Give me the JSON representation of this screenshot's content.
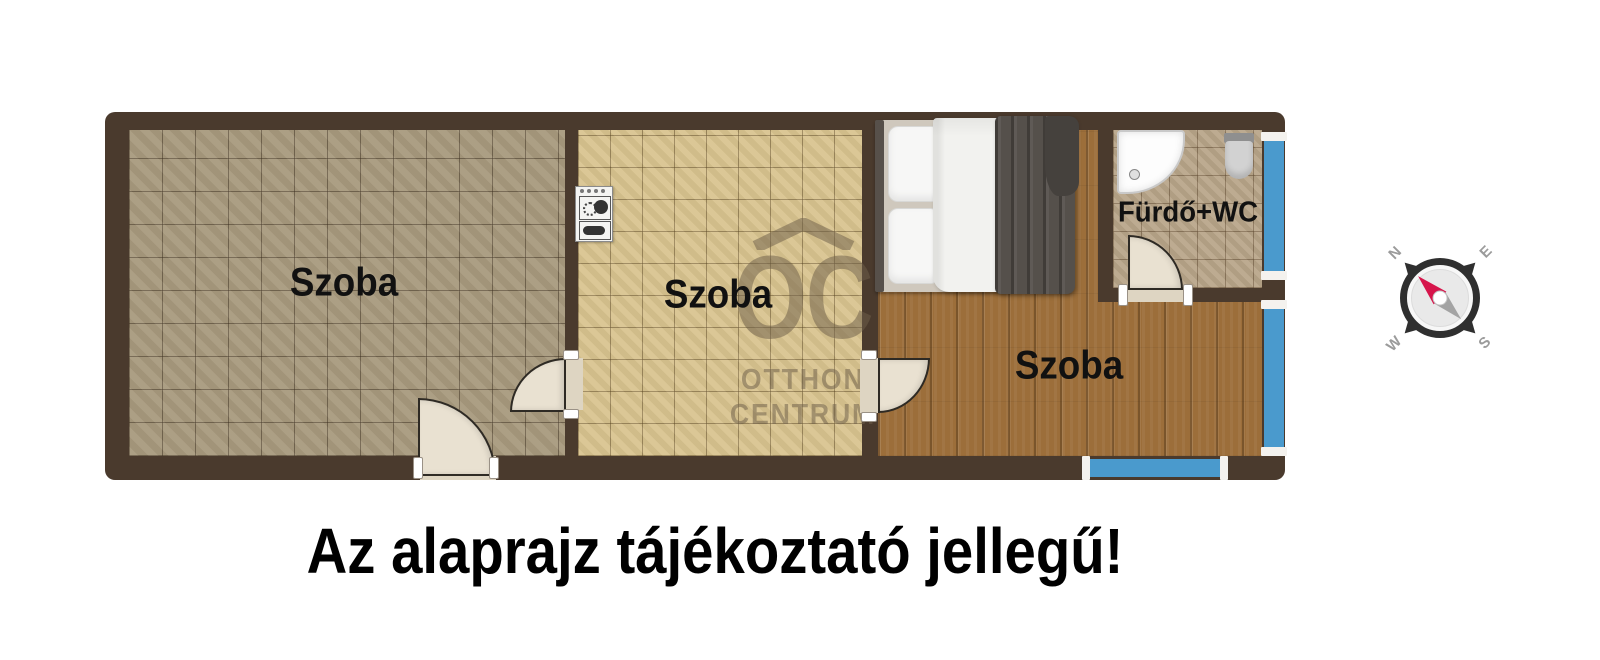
{
  "floorplan": {
    "disclaimer": "Az alaprajz tájékoztató jellegű!",
    "rooms": [
      {
        "id": "room-left",
        "label": "Szoba"
      },
      {
        "id": "room-middle",
        "label": "Szoba"
      },
      {
        "id": "room-bedroom",
        "label": "Szoba"
      },
      {
        "id": "bathroom",
        "label": "Fürdő+WC"
      }
    ],
    "watermark": {
      "monogram": "OC",
      "line1": "OTTHON",
      "line2": "CENTRUM"
    },
    "compass": {
      "north": "N",
      "east": "E",
      "south": "S",
      "west": "W"
    },
    "colors": {
      "wall": "#4a3a2d",
      "room_left_floor": "#a89a7e",
      "room_middle_floor": "#d9c48f",
      "bedroom_floor": "#9c6e3a",
      "bathroom_floor": "#b9a68a",
      "window": "#4a9acd",
      "door_leaf": "#e9e1d1",
      "compass_needle": "#d6154b",
      "blanket": "#55504b"
    }
  }
}
